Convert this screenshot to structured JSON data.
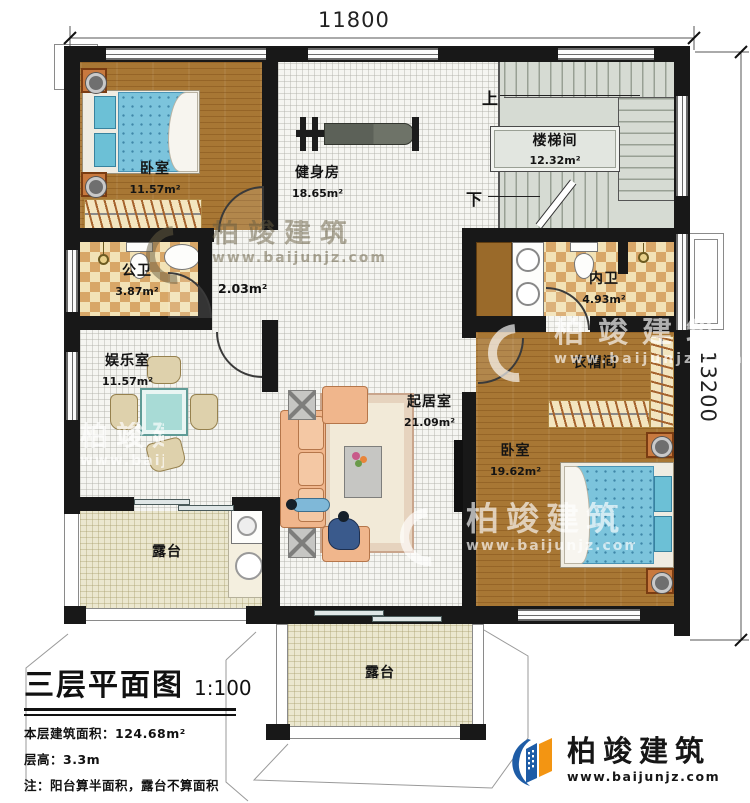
{
  "plan": {
    "dimensions": {
      "top": "11800",
      "right": "13200"
    },
    "stair_marks": {
      "up": "上",
      "down": "下"
    },
    "rooms": {
      "bedroom1": {
        "name": "卧室",
        "area": "11.57m²"
      },
      "gym": {
        "name": "健身房",
        "area": "18.65m²"
      },
      "stairwell": {
        "name": "楼梯间",
        "area": "12.32m²"
      },
      "public_bath": {
        "name": "公卫",
        "area": "3.87m²"
      },
      "hallway": {
        "area": "2.03m²"
      },
      "private_bath": {
        "name": "内卫",
        "area": "4.93m²"
      },
      "entertainment": {
        "name": "娱乐室",
        "area": "11.57m²"
      },
      "living": {
        "name": "起居室",
        "area": "21.09m²"
      },
      "cloakroom": {
        "name": "衣帽间"
      },
      "bedroom2": {
        "name": "卧室",
        "area": "19.62m²"
      },
      "terrace_left": {
        "name": "露台"
      },
      "terrace_bottom": {
        "name": "露台"
      }
    }
  },
  "title_block": {
    "title": "三层平面图",
    "scale": "1:100",
    "floor_area": "本层建筑面积：124.68m²",
    "floor_height": "层高：3.3m",
    "note": "注：阳台算半面积，露台不算面积"
  },
  "branding": {
    "name": "柏竣建筑",
    "website": "www.baijunjz.com"
  },
  "watermark": {
    "name": "柏竣建筑",
    "website": "www.baijunjz.com"
  },
  "colors": {
    "wall": "#181818",
    "wood": "#a87734",
    "checker_tile": "#d8a768",
    "terrace": "#ebe7cf",
    "stair": "#d6dbd3",
    "logo_blue": "#1e5ca6",
    "logo_orange": "#f39512"
  }
}
